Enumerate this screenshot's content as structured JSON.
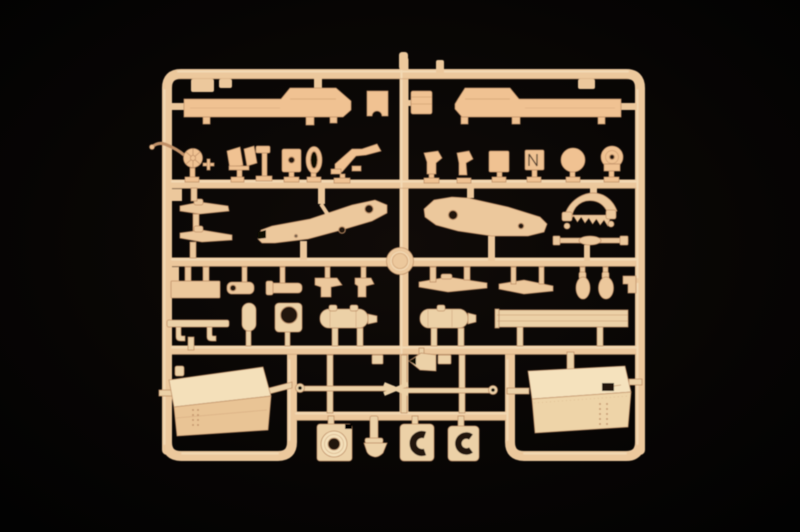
{
  "scene": {
    "type": "photograph",
    "subject": "Tan injection-molded plastic model kit sprue (parts tree) lying on a black studio background",
    "orientation": "sprue frame centered, occupying middle of image",
    "visible_text": ""
  },
  "colors": {
    "bg_center": "#100b08",
    "bg_mid": "#070504",
    "bg_edge": "#020202",
    "plastic_warm": "#f0c292",
    "plastic_mid": "#ecc89c",
    "plastic_pale": "#ecd1a7",
    "plastic_light": "#f9e8c9",
    "plastic_dark": "#bf8f66",
    "hole_dark": "#241710",
    "tank_top_left": "#f4e0ba",
    "tank_front_left": "#e9c495",
    "tank_top_right": "#f5e2bd",
    "tank_front_right": "#eed4a8"
  },
  "part_labels": {
    "hull_left": "long chassis/hull side piece (top left)",
    "hull_right": "long chassis/hull side piece (top right)",
    "handwheel": "spoked handwheel with curved arm",
    "gear_sector": "toothed gear sector",
    "frame_left": "carriage frame side member (left)",
    "frame_right": "carriage frame side member (right)",
    "propeller_blades": "thin blade/linkage pieces on left edge",
    "muffler_left": "ribbed cylinder (muffler)",
    "muffler_right": "ribbed cylinder (muffler)",
    "channel_beam": "long channel beam",
    "fuel_tank_left": "large box fuel tank (left)",
    "fuel_tank_right": "large box fuel tank (right)",
    "towbar": "crossed tow-bar rods with eyelets",
    "medallion": "round sprue center boss",
    "mount_block": "block with round boss and bore",
    "clamp_c_1": "C-shaped clamp block",
    "clamp_c_2": "C-shaped clamp block",
    "small_fittings": "assorted small brackets, plates, discs and drums"
  }
}
